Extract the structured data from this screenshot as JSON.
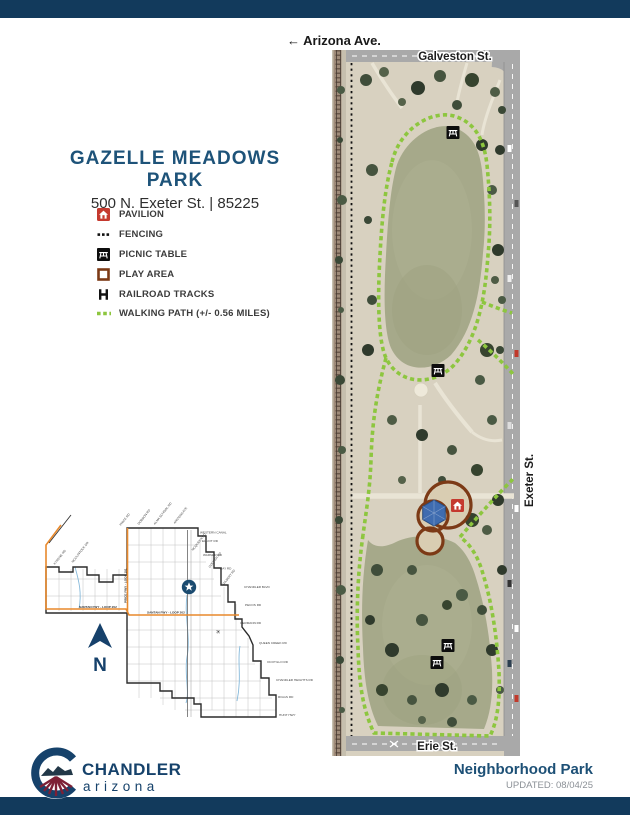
{
  "park": {
    "title": "GAZELLE MEADOWS PARK",
    "address": "500 N. Exeter St. | 85225"
  },
  "streets": {
    "arizona_ave": "← Arizona Ave.",
    "galveston": "Galveston St.",
    "exeter": "Exeter St.",
    "erie": "Erie St."
  },
  "legend": {
    "items": [
      {
        "icon": "pavilion-icon",
        "label": "PAVILION"
      },
      {
        "icon": "fencing-icon",
        "label": "FENCING"
      },
      {
        "icon": "picnic-table-icon",
        "label": "PICNIC TABLE"
      },
      {
        "icon": "play-area-icon",
        "label": "PLAY AREA"
      },
      {
        "icon": "railroad-tracks-icon",
        "label": "RAILROAD TRACKS"
      },
      {
        "icon": "walking-path-icon",
        "label": "WALKING PATH (+/- 0.56 MILES)"
      }
    ]
  },
  "inset_map": {
    "north_label": "N",
    "freeway_labels": [
      "SANTAN FWY - LOOP 202",
      "SANTAN FWY - LOOP 202",
      "PRICE FWY - LOOP 101"
    ],
    "street_labels": [
      "WESTERN CANAL",
      "ELLIOT RD",
      "WARNER RD",
      "RAY RD",
      "CHANDLER BLVD",
      "PECOS RD",
      "GERMANN RD",
      "QUEEN CREEK RD",
      "OCOTILLO RD",
      "CHANDLER HEIGHTS RD",
      "RIGGS RD",
      "HUNT HWY"
    ],
    "rotated_labels": [
      "KYRENE RD",
      "MCCLINTOCK DR",
      "PRICE RD",
      "DOBSON RD",
      "ALMA SCHOOL RD",
      "ARIZONA AVE",
      "MCQUEEN RD",
      "COOPER RD",
      "GILBERT RD"
    ]
  },
  "logo": {
    "city": "CHANDLER",
    "state": "arizona"
  },
  "footer": {
    "park_type": "Neighborhood Park",
    "updated": "UPDATED: 08/04/25"
  },
  "colors": {
    "navy_bar": "#123a5c",
    "title_blue": "#1e5379",
    "path_green": "#8dc63f",
    "play_area_brown": "#7c3a16",
    "pavilion_red": "#c5392e",
    "freeway_orange": "#e8892c",
    "logo_navy": "#16426b",
    "logo_maroon": "#7d2035"
  }
}
